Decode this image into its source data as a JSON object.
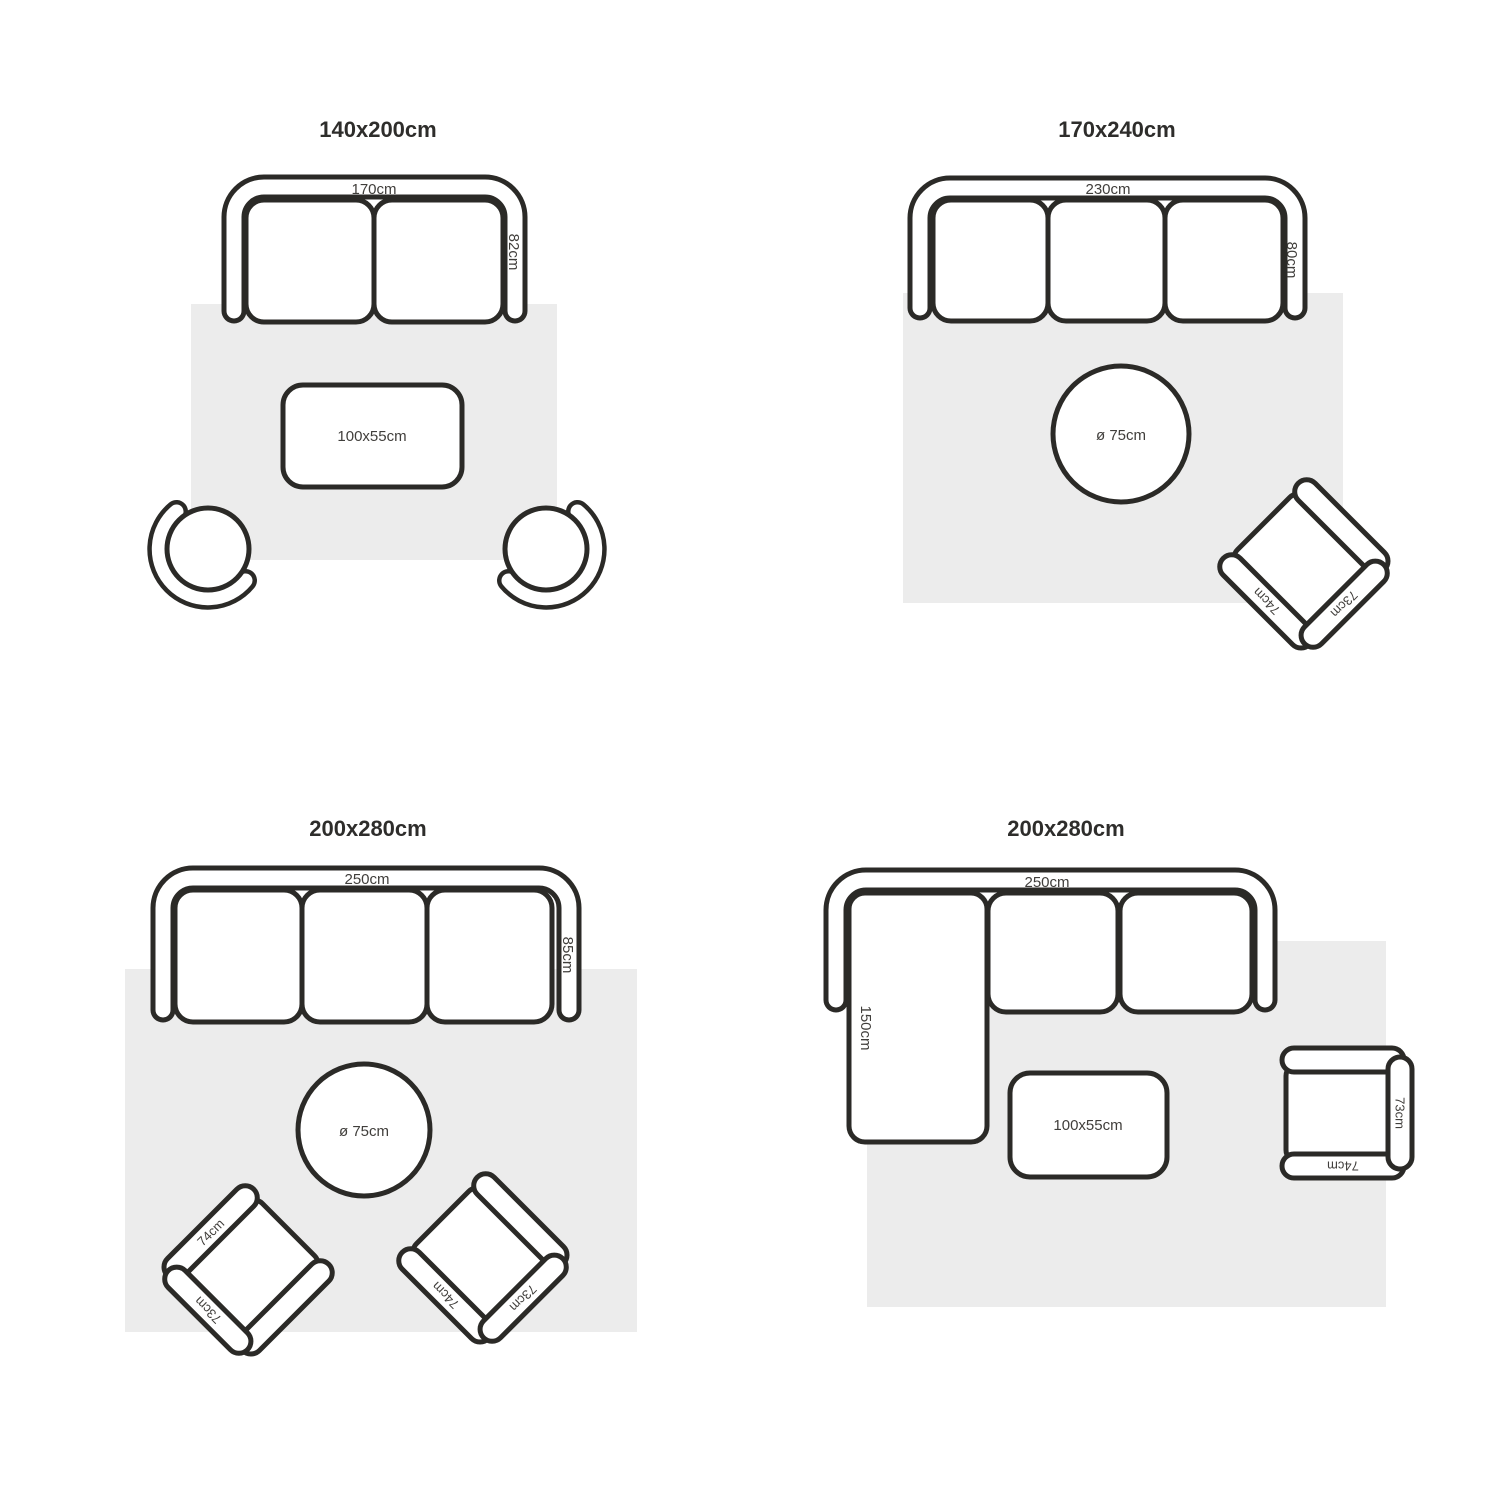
{
  "colors": {
    "background": "#ffffff",
    "rug": "#ececec",
    "outline": "#2b2a27",
    "label_text": "#403e3b",
    "title_text": "#2e2d2b"
  },
  "layouts": [
    {
      "title": "140x200cm",
      "sofa": {
        "width": "170cm",
        "depth": "82cm"
      },
      "coffee_table": "100x55cm"
    },
    {
      "title": "170x240cm",
      "sofa": {
        "width": "230cm",
        "depth": "80cm"
      },
      "side_table": "ø 75cm",
      "armchair": {
        "side": "74cm",
        "back": "73cm"
      }
    },
    {
      "title": "200x280cm",
      "sofa": {
        "width": "250cm",
        "depth": "85cm"
      },
      "side_table": "ø 75cm",
      "armchair_left": {
        "side": "74cm",
        "back": "73cm"
      },
      "armchair_right": {
        "side": "74cm",
        "back": "73cm"
      }
    },
    {
      "title": "200x280cm",
      "sofa": {
        "width": "250cm",
        "chaise": "150cm"
      },
      "coffee_table": "100x55cm",
      "armchair": {
        "side": "74cm",
        "back": "73cm"
      }
    }
  ]
}
